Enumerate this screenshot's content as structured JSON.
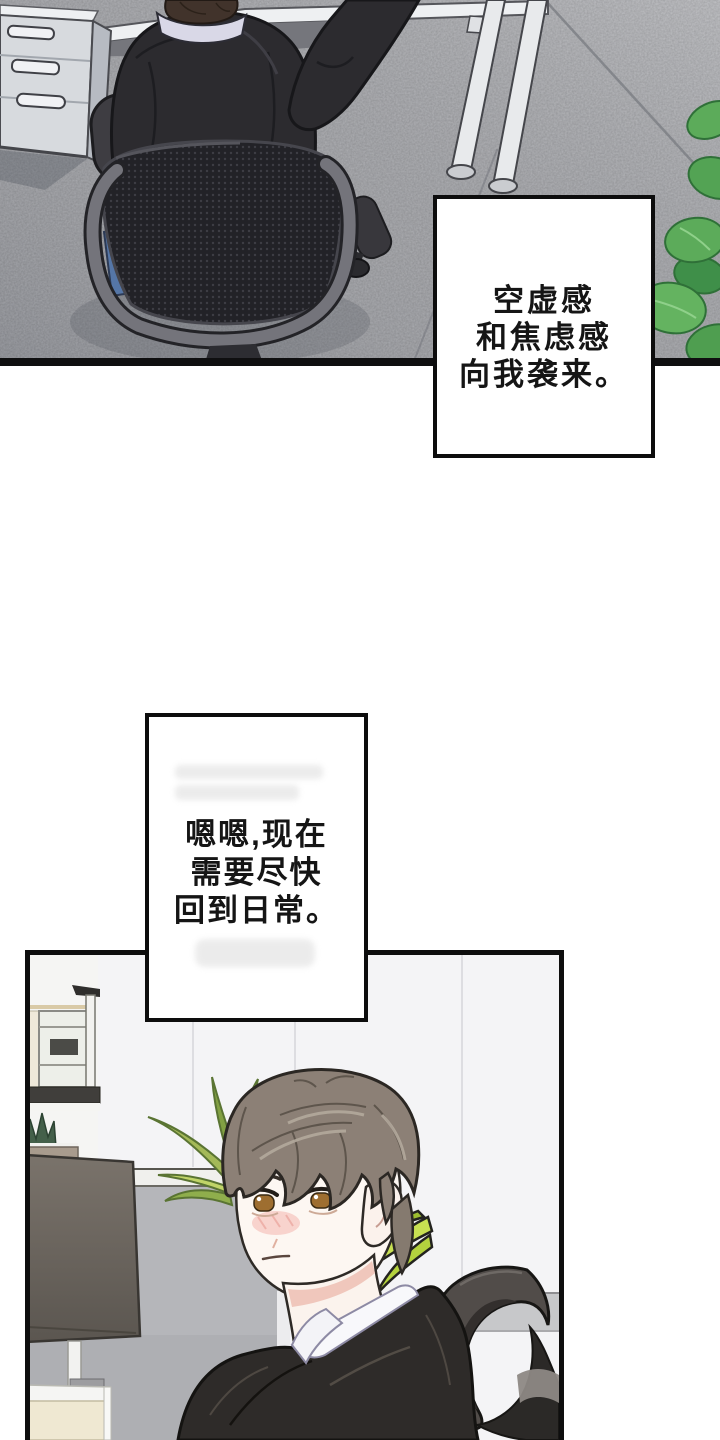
{
  "page": {
    "type": "comic-page",
    "background": "#ffffff"
  },
  "captions": {
    "box1": {
      "lines": [
        "空虚感",
        "和焦虑感",
        "向我袭来。"
      ]
    },
    "box2": {
      "lines": [
        "嗯嗯,现在",
        "需要尽快",
        "回到日常。"
      ]
    }
  },
  "panels": {
    "top": {
      "alt": "俯视:穿黑衣的男人坐在黑色网布办公椅上向上伸手,左侧是灰色文件柜,右上是白色办公桌腿,右侧有绿植,地面为灰色地毯"
    },
    "bottom": {
      "alt": "办公隔间:灰棕色头发的男人回头看,身后有绿植、显示器、米色办公桌和黑色办公椅头枕"
    }
  },
  "palette": {
    "panel_border": "#0e0e0e",
    "carpet_gray": "#a8a9ad",
    "cabinet_gray": "#d7dade",
    "desk_white": "#eef0f2",
    "chair_mesh_black": "#222227",
    "chair_frame_gray": "#74747b",
    "chair_seat_blue": "#5576a7",
    "plant_green": "#5cab5a",
    "leaf_yellow_green": "#c8e052",
    "hair_ash_brown": "#8c8076",
    "skin": "#fdf7f2",
    "blush_pink": "#f6c9c3",
    "eye_amber": "#9e6e30",
    "jacket_black": "#2e2b29",
    "shirt_white": "#f8f8fb",
    "partition_gray": "#b5b6ba",
    "monitor_gray": "#746d66",
    "desk_cream": "#efe8d2"
  }
}
